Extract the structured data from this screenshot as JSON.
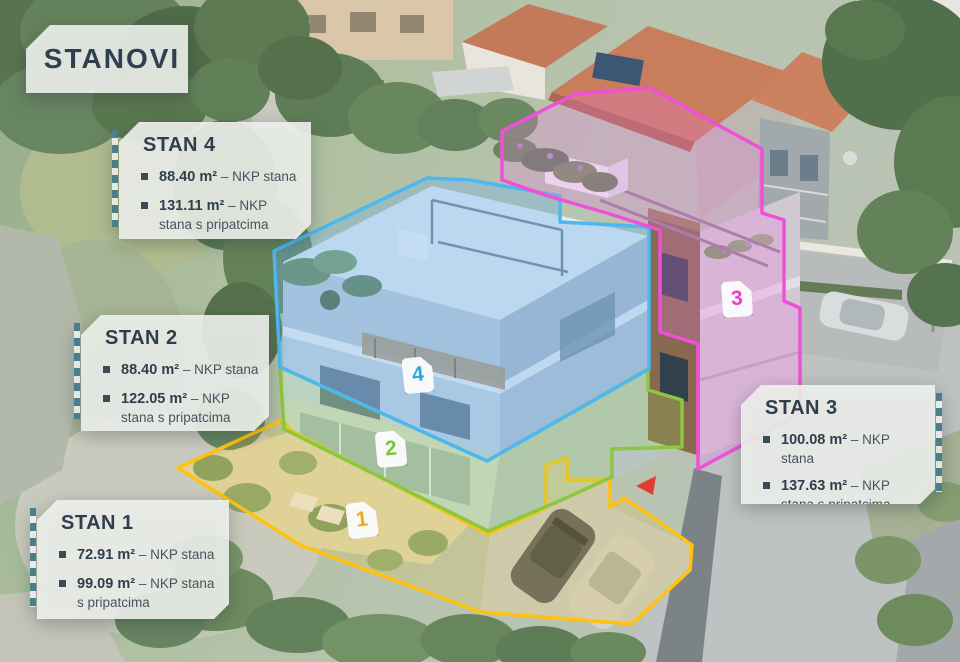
{
  "title_card": {
    "label": "STANOVI"
  },
  "cards": [
    {
      "id": "stan-4",
      "title": "STAN 4",
      "items": [
        {
          "value": "88.40 m²",
          "label": "– NKP stana"
        },
        {
          "value": "131.11 m²",
          "label": "– NKP stana s pripatcima"
        }
      ]
    },
    {
      "id": "stan-2",
      "title": "STAN 2",
      "items": [
        {
          "value": "88.40 m²",
          "label": "– NKP stana"
        },
        {
          "value": "122.05 m²",
          "label": "– NKP stana s pripatcima"
        }
      ]
    },
    {
      "id": "stan-1",
      "title": "STAN 1",
      "items": [
        {
          "value": "72.91 m²",
          "label": "– NKP stana"
        },
        {
          "value": "99.09 m²",
          "label": "– NKP stana s pripatcima"
        }
      ]
    },
    {
      "id": "stan-3",
      "title": "STAN 3",
      "items": [
        {
          "value": "100.08 m²",
          "label": "– NKP stana"
        },
        {
          "value": "137.63 m²",
          "label": "– NKP stana s pripatcima"
        }
      ]
    }
  ],
  "badges": [
    {
      "number": "1",
      "color": "#F2A71B"
    },
    {
      "number": "2",
      "color": "#7DC242"
    },
    {
      "number": "3",
      "color": "#E93CC7"
    },
    {
      "number": "4",
      "color": "#2EA7E0"
    }
  ],
  "apartments": {
    "a1": {
      "stroke": "#FFC20E",
      "fill": "rgba(255,196,30,0.16)"
    },
    "a2": {
      "stroke": "#8DC63F",
      "fill": "rgba(150,214,92,0.22)"
    },
    "a3": {
      "stroke": "#F050D8",
      "fill": "rgba(240,120,230,0.26)"
    },
    "a4": {
      "stroke": "#4DB8F0",
      "fill": "rgba(105,178,238,0.32)"
    }
  }
}
